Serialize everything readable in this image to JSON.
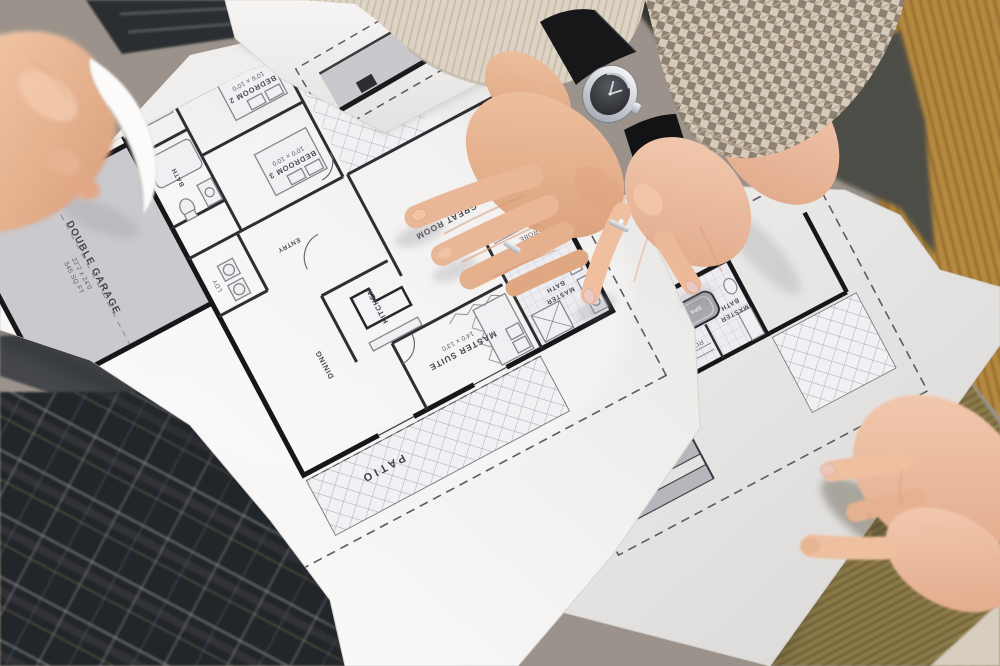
{
  "blueprint_main": {
    "rooms": [
      {
        "label": "DOUBLE GARAGE",
        "dims": "22'2 x 24'0",
        "area": "545 SQ FT"
      },
      {
        "label": "MASTER SUITE",
        "dims": "14'0 x 13'0"
      },
      {
        "label": "GREAT ROOM",
        "dims": "17'0 x 15'0"
      },
      {
        "label": "KITCHEN"
      },
      {
        "label": "DINING"
      },
      {
        "label": "ENTRY"
      },
      {
        "label": "BEDROOM 3",
        "dims": "10'0 x 10'0"
      },
      {
        "label": "BEDROOM 2",
        "dims": "10'6 x 10'0"
      },
      {
        "label": "BATH"
      },
      {
        "l1": "MASTER",
        "l2": "BATH"
      },
      {
        "label": "ROBE"
      },
      {
        "label": "LDY"
      },
      {
        "label": "PATIO"
      }
    ]
  },
  "blueprint_under": {
    "rooms": [
      {
        "l1": "MASTER",
        "l2": "BATH"
      },
      {
        "label": "ROBE"
      },
      {
        "label": "SPA TUB"
      }
    ]
  },
  "palette": {
    "paper": "#f5f3f1",
    "ink": "#1b1b1e",
    "hatch_line": "#a6a6b0",
    "garage_fill": "#c9c9ce",
    "couch": "#b5893f",
    "olive_knit": "#8d7c4a",
    "cream_sweater": "#ded4c6",
    "houndstooth": "#d6cbbb",
    "plaid": "#23262b",
    "wood": "#c2a176",
    "skin": "#e9b797",
    "watch_strap": "#17171a",
    "nail_polish": "#ecc8c0"
  }
}
